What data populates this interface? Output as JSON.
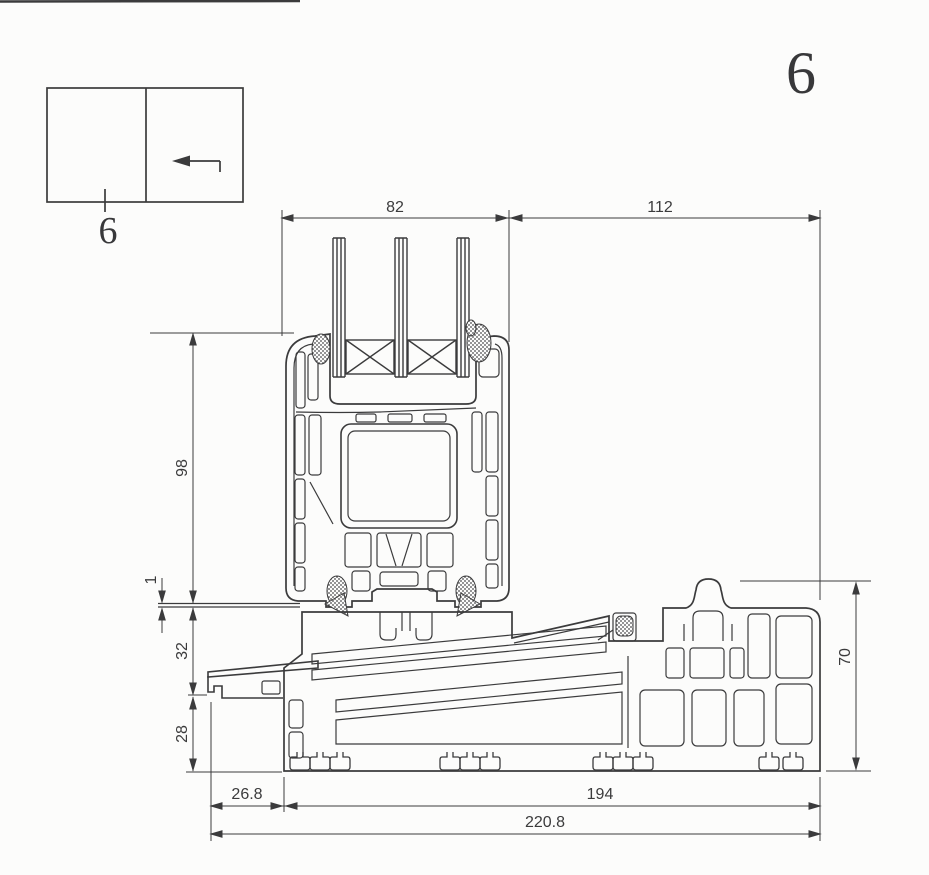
{
  "sheet": {
    "number": "6",
    "background": "#fcfcfb",
    "line_color": "#3b3b3c",
    "drawing_type": "window-sill-cross-section"
  },
  "key_diagram": {
    "section_label": "6",
    "arrow_icon": "left-arrow"
  },
  "dimensions": {
    "top": [
      {
        "label": "82"
      },
      {
        "label": "112"
      }
    ],
    "left": [
      {
        "label": "98"
      },
      {
        "label": "1"
      },
      {
        "label": "32"
      },
      {
        "label": "28"
      }
    ],
    "right": [
      {
        "label": "70"
      }
    ],
    "bottom": [
      {
        "label": "26.8"
      },
      {
        "label": "194"
      },
      {
        "label": "220.8"
      }
    ]
  }
}
